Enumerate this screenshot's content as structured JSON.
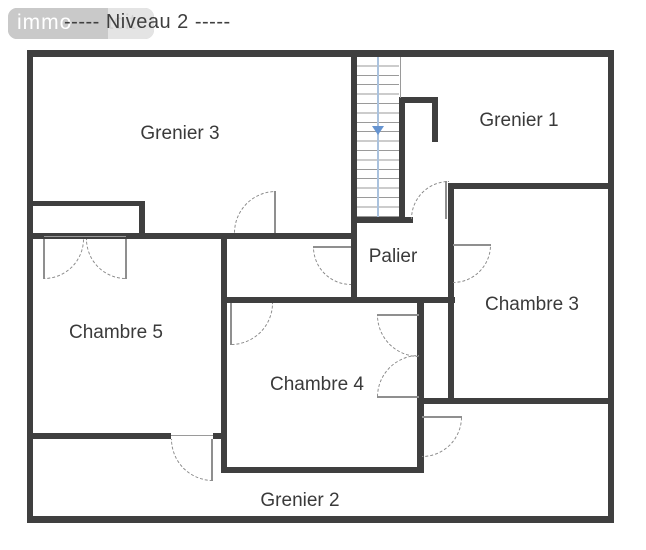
{
  "header": {
    "title": "----- Niveau 2 -----",
    "logo": {
      "primary": "immo",
      "secondary": "toit"
    }
  },
  "rooms": {
    "grenier3": "Grenier 3",
    "grenier1": "Grenier 1",
    "palier": "Palier",
    "chambre5": "Chambre 5",
    "chambre3": "Chambre 3",
    "chambre4": "Chambre 4",
    "grenier2": "Grenier 2"
  },
  "stairs": {
    "direction": "down"
  },
  "colors": {
    "wall": "#3f3f3f",
    "thin": "#9a9a9a",
    "arc": "#8a8a8a",
    "leaf": "#8f8f8f",
    "stairline": "#aac2de",
    "stairarrow": "#6593d0",
    "text": "#3a3a3a"
  }
}
